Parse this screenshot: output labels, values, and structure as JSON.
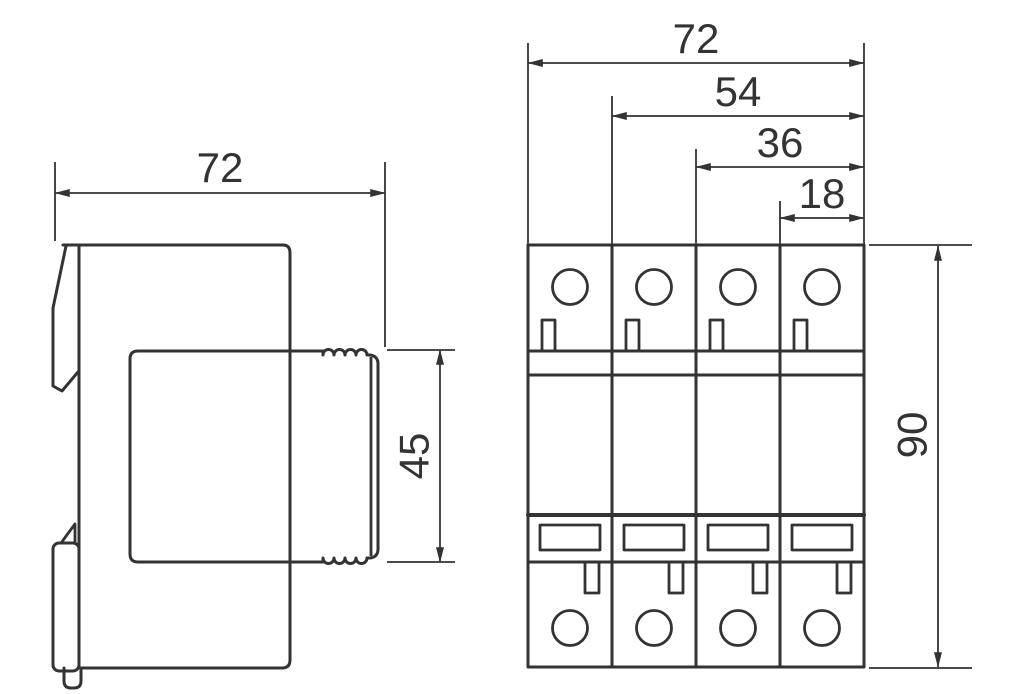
{
  "colors": {
    "line": "#333333",
    "background": "#ffffff"
  },
  "side_view": {
    "dim_width": "72",
    "dim_plug_height": "45"
  },
  "front_view": {
    "dim_total_width": "72",
    "dim_three_modules": "54",
    "dim_two_modules": "36",
    "dim_one_module": "18",
    "dim_height": "90"
  }
}
